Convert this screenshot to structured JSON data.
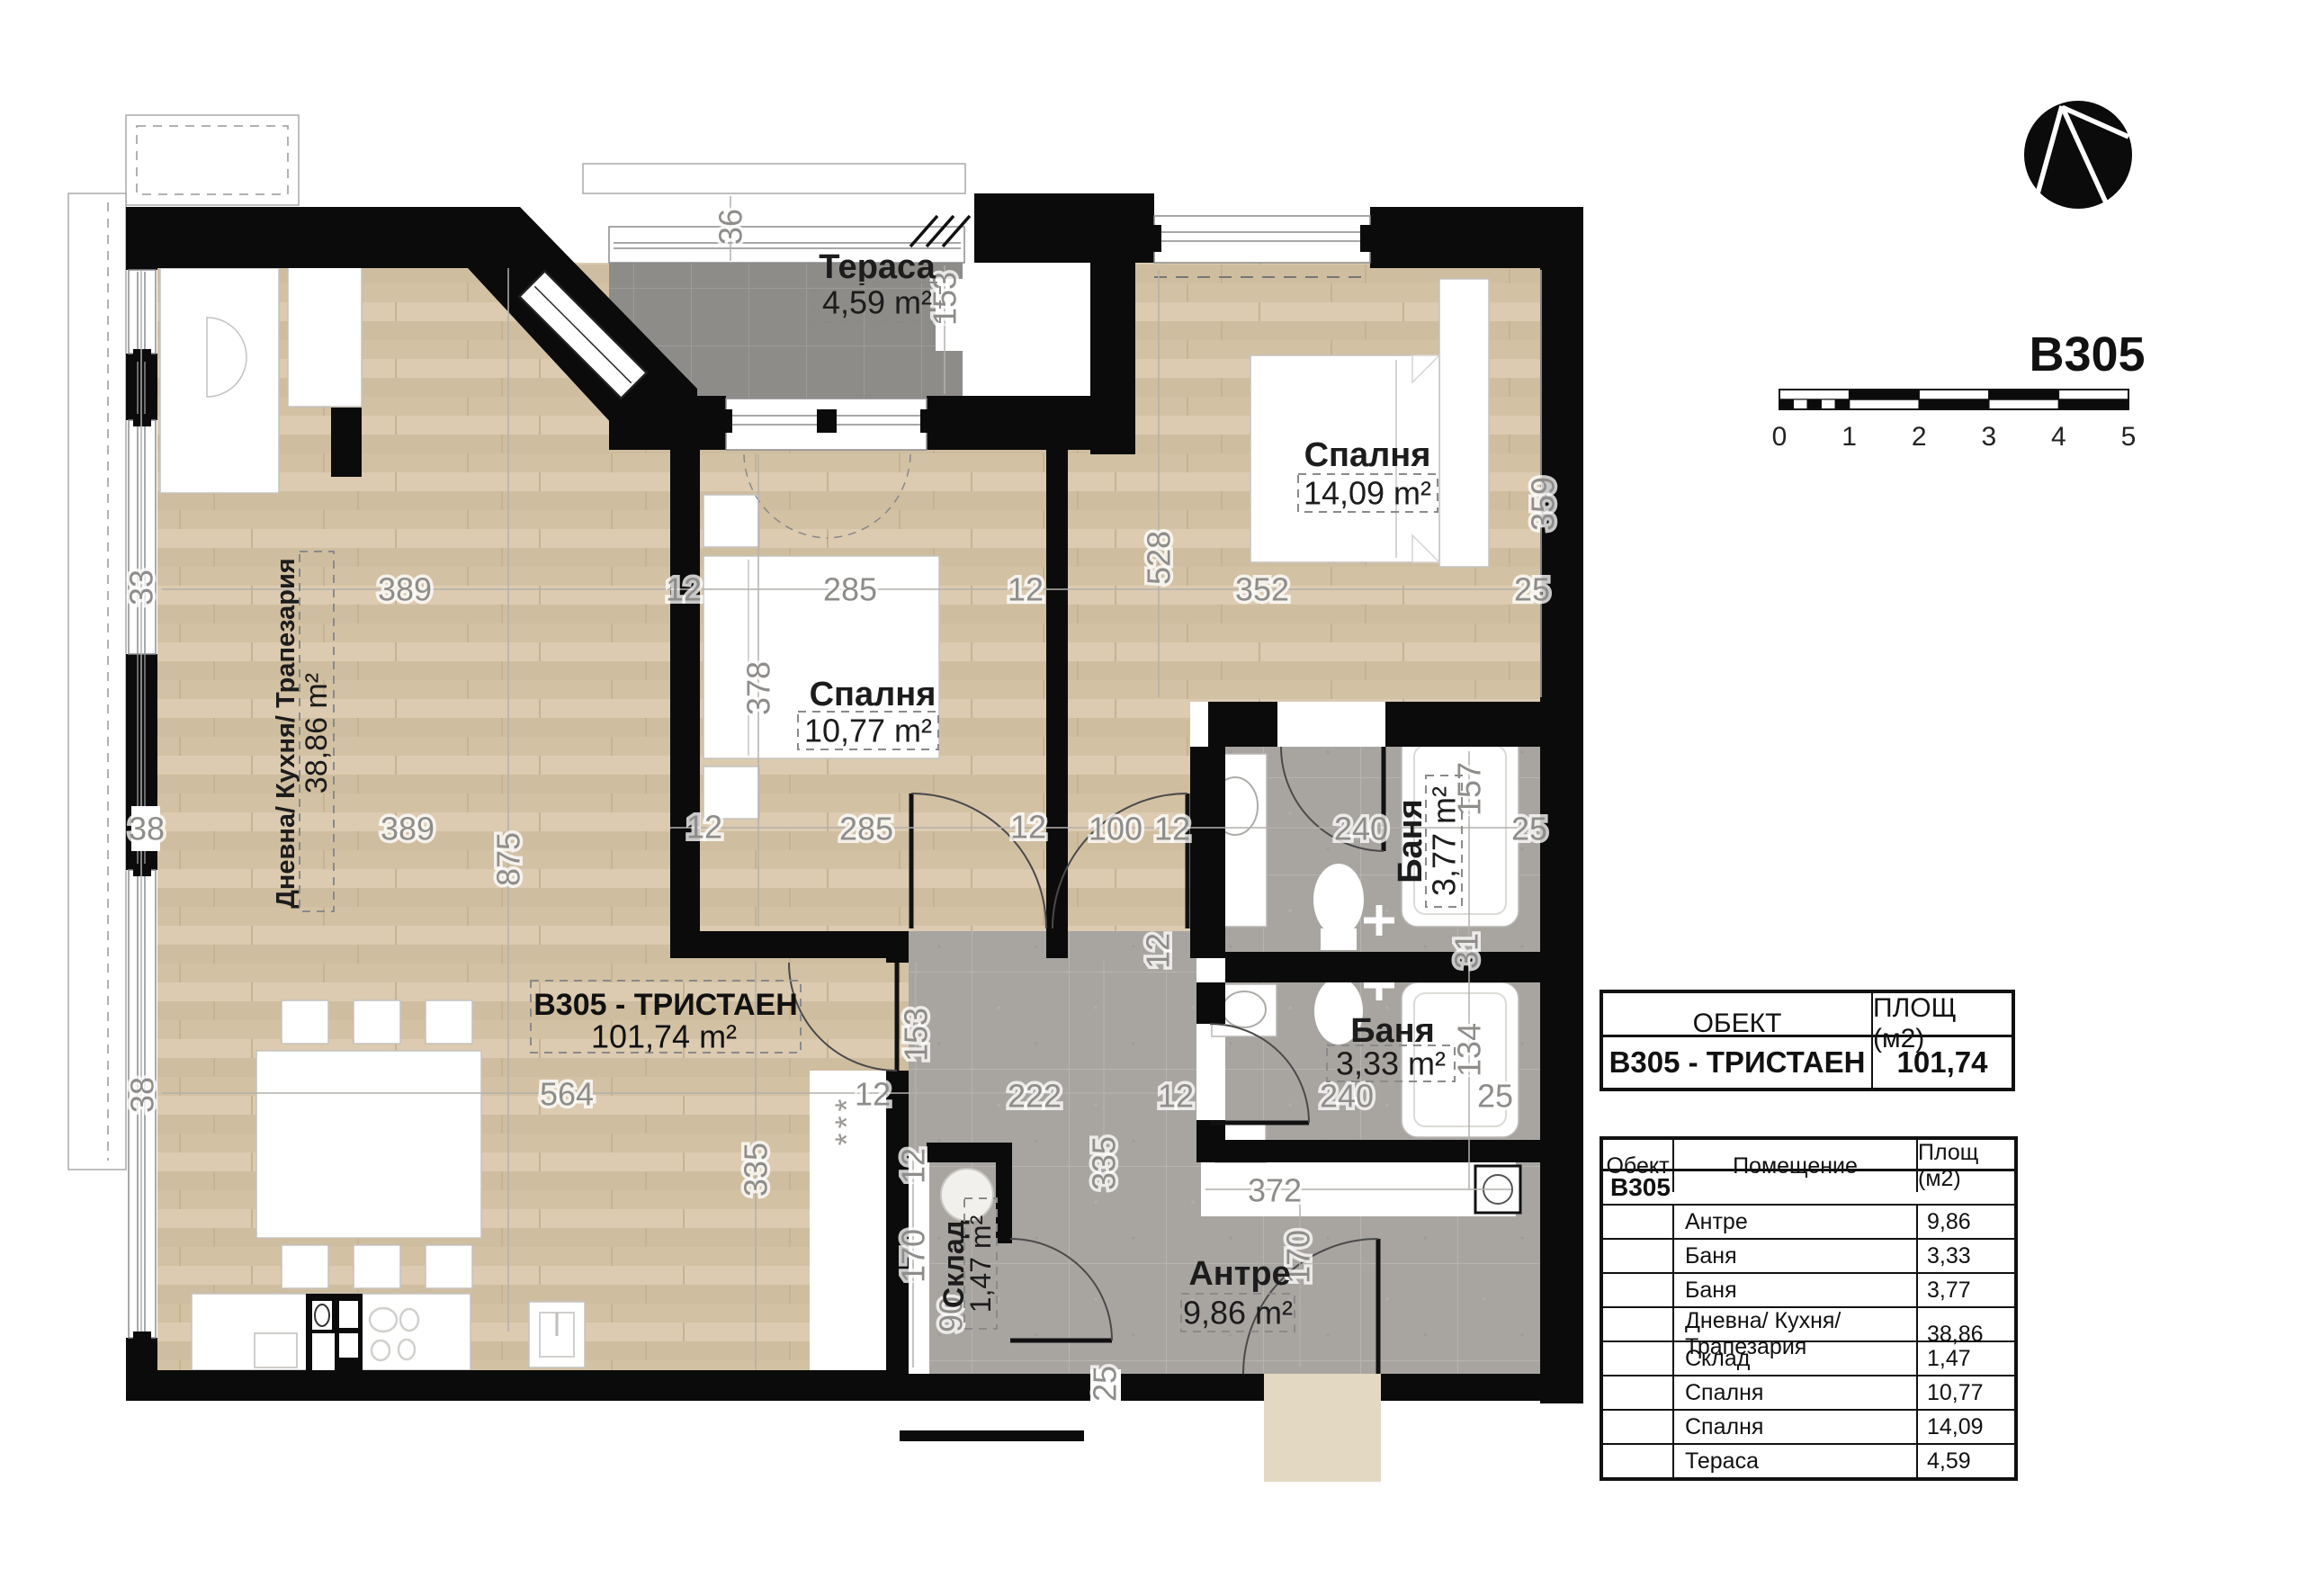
{
  "header": {
    "unit_code": "B305"
  },
  "scale_bar": {
    "ticks": [
      "0",
      "1",
      "2",
      "3",
      "4",
      "5"
    ]
  },
  "plan": {
    "unit_box": {
      "name": "B305 - ТРИСТАЕН",
      "area": "101,74 m²"
    },
    "rooms": {
      "terrace": {
        "name": "Тераса",
        "area": "4,59 m²"
      },
      "bedroom_right": {
        "name": "Спалня",
        "area": "14,09 m²"
      },
      "bedroom_mid": {
        "name": "Спалня",
        "area": "10,77 m²"
      },
      "living": {
        "name": "Дневна/ Кухня/ Трапезария",
        "area": "38,86 m²"
      },
      "bath_top": {
        "name": "Баня",
        "area": "3,77 m²"
      },
      "bath_bottom": {
        "name": "Баня",
        "area": "3,33 m²"
      },
      "storage": {
        "name": "Склад",
        "area": "1,47 m²"
      },
      "hall": {
        "name": "Антре",
        "area": "9,86 m²"
      }
    },
    "closet_marks": "***",
    "dims": [
      "36",
      "153",
      "389",
      "12",
      "285",
      "12",
      "528",
      "352",
      "25",
      "359",
      "378",
      "38",
      "389",
      "875",
      "12",
      "285",
      "12",
      "100",
      "12",
      "240",
      "157",
      "25",
      "12",
      "31",
      "153",
      "134",
      "564",
      "12",
      "222",
      "12",
      "240",
      "25",
      "335",
      "335",
      "372",
      "12",
      "170",
      "90",
      "170",
      "25",
      "33",
      "38"
    ]
  },
  "summary_table": {
    "col_object": "ОБЕКТ",
    "col_area": "ПЛОЩ (м2)",
    "object": "B305 - ТРИСТАЕН",
    "area": "101,74"
  },
  "rooms_table": {
    "col_object": "Обект",
    "col_room": "Помещение",
    "col_area": "Площ (м2)",
    "group": "B305",
    "rows": [
      {
        "room": "Антре",
        "area": "9,86"
      },
      {
        "room": "Баня",
        "area": "3,33"
      },
      {
        "room": "Баня",
        "area": "3,77"
      },
      {
        "room": "Дневна/ Кухня/ Трапезария",
        "area": "38,86"
      },
      {
        "room": "Склад",
        "area": "1,47"
      },
      {
        "room": "Спалня",
        "area": "10,77"
      },
      {
        "room": "Спалня",
        "area": "14,09"
      },
      {
        "room": "Тераса",
        "area": "4,59"
      }
    ]
  }
}
